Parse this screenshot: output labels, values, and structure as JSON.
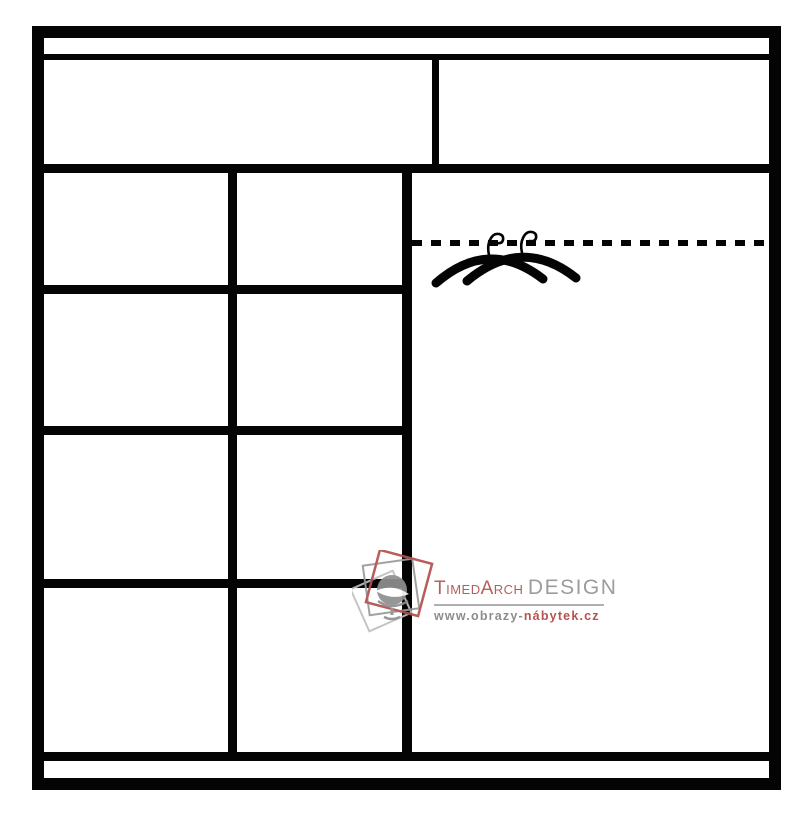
{
  "page": {
    "background_color": "#ffffff",
    "line_color": "#040404"
  },
  "diagram": {
    "kind": "wardrobe-interior-front-schematic",
    "top_compartments": 2,
    "left_shelf_columns": 2,
    "left_shelf_rows": 4,
    "hanging_section": {
      "rail_style": "dashed-line",
      "hangers_count": 2
    },
    "icons": [
      "clothes-hangers-icon",
      "watermark-logo-squares-icon",
      "armchair-icon"
    ]
  },
  "watermark": {
    "brand_primary": "TimedArch",
    "brand_secondary": "DESIGN",
    "url_prefix": "www.obrazy-",
    "url_suffix": "nábytek.cz",
    "colors": {
      "brand_red": "#b3605c",
      "brand_gray": "#9c9c9c",
      "url_gray": "#8d8d8d",
      "url_red": "#b5534e",
      "rule_gray": "#b0b0b0",
      "logo_square_red": "#b24f4f",
      "logo_square_gray": "#9a9a9a",
      "logo_square_lightgray": "#c0c0c0",
      "logo_chair_gray": "#8f8f8f"
    }
  }
}
